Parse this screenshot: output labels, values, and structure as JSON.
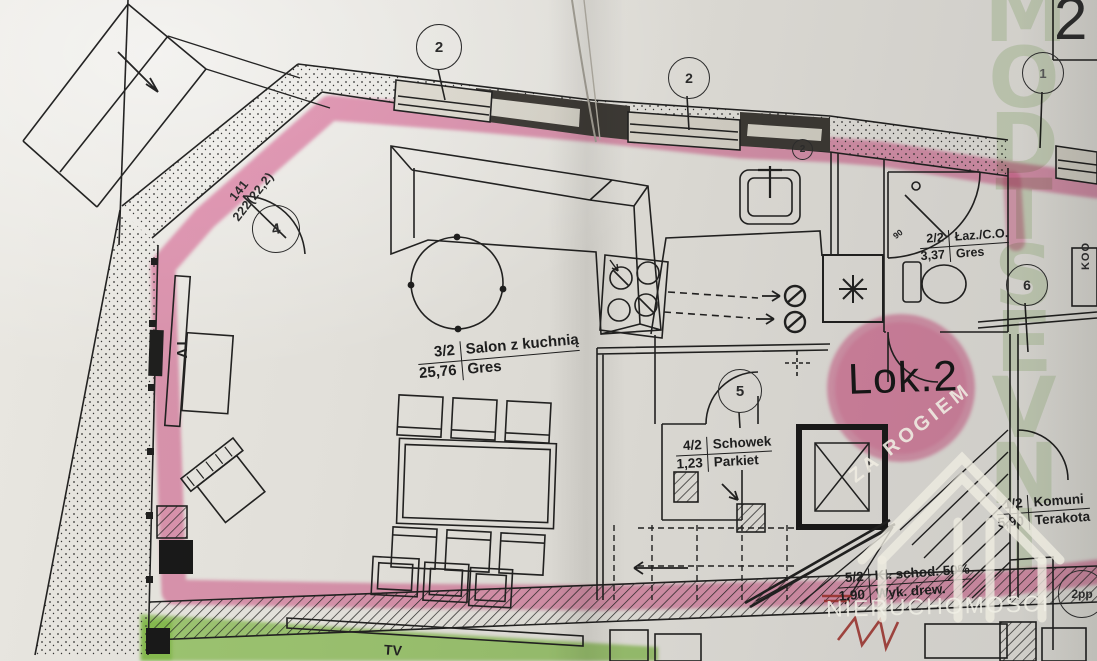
{
  "sheet": {
    "number": "2",
    "side_text": "KOO"
  },
  "unit": {
    "label": "Lok.2"
  },
  "rooms": [
    {
      "number": "3/2",
      "name": "Salon z kuchnią",
      "area": "25,76",
      "floor": "Gres"
    },
    {
      "number": "2/2",
      "name": "Łaz./C.O.",
      "area": "3,37",
      "floor": "Gres"
    },
    {
      "number": "4/2",
      "name": "Schowek",
      "area": "1,23",
      "floor": "Parkiet"
    },
    {
      "number": "1/2",
      "name": "Komuni",
      "area": "5,90",
      "floor": "Terakota"
    },
    {
      "number": "5/2",
      "name": "Kl. schod. 50%",
      "area": "1,90",
      "floor": "Wyk. drew."
    }
  ],
  "markers": {
    "window_top_left": "2",
    "window_kitchen": "2",
    "window_right": "1",
    "door_entry": "4",
    "door_storage": "5",
    "bathroom": "6",
    "stairs": "2pp",
    "wall_small": "2"
  },
  "dimensions": {
    "line1": "141",
    "line2": "222(22,2)"
  },
  "furniture": {
    "tv_label": "TV",
    "tv_label_bottom": "TV",
    "shower_size": "90"
  },
  "watermark": {
    "diagonal": "ZA ROGIEM",
    "bottom": "NIERUCHOMOŚCI",
    "vertical_letters": [
      "M",
      "O",
      "D",
      "T",
      "S",
      "E",
      "V",
      "N",
      "I"
    ]
  },
  "colors": {
    "highlight_pink": "#e2538f",
    "highlight_green": "#76c32e",
    "watermark_green": "#94aa7e",
    "ink": "#262626",
    "red_mark": "#b3342e"
  }
}
